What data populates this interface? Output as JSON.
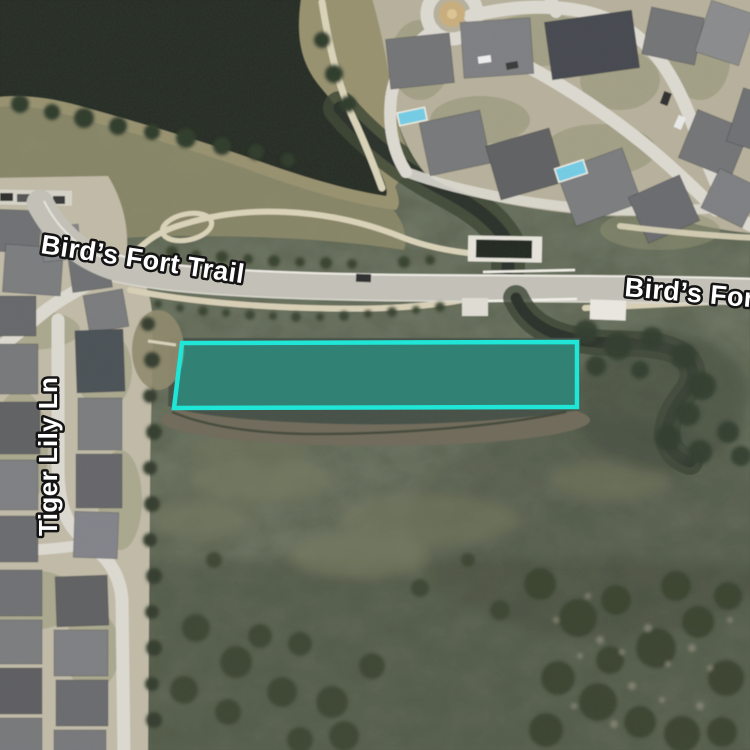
{
  "map": {
    "view_type": "satellite",
    "road_labels": [
      {
        "id": "birds-fort-trail-west",
        "text": "Bird’s Fort Trail"
      },
      {
        "id": "birds-fort-trail-east",
        "text": "Bird’s Fort Trail"
      },
      {
        "id": "tiger-lily-ln",
        "text": "Tiger Lily Ln"
      }
    ],
    "parcel_highlight": {
      "points": "182,343 577,342 577,407 174,408",
      "stroke_color": "#1FE6D6",
      "fill_color": "rgba(0,230,208,0.32)",
      "stroke_width": "4.5"
    },
    "palette": {
      "field": "#565E4C",
      "pond_water": "#262C25",
      "road": "#C3C1B7",
      "concrete_street": "#DCD9D0",
      "trail": "#D9D2B8",
      "highlight": "#1FE6D6"
    }
  }
}
